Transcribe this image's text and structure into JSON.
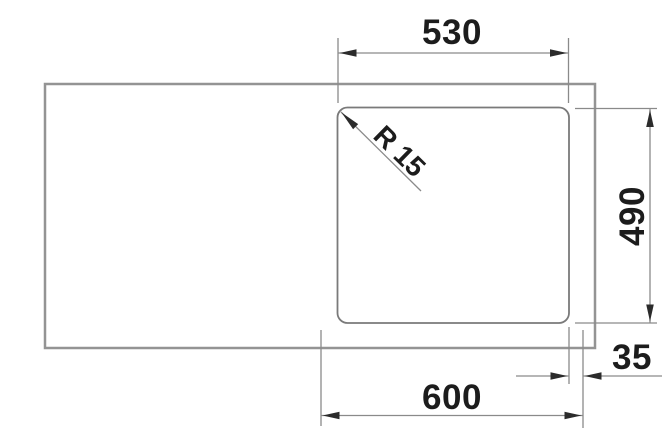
{
  "drawing": {
    "type": "technical-dimension-drawing",
    "subject": "sink-cutout-installation-plan",
    "labels": {
      "cutout_width": "530",
      "cutout_depth": "490",
      "edge_offset": "35",
      "cabinet_width": "600",
      "corner_radius": "R 15"
    },
    "colors": {
      "background": "#ffffff",
      "outline": "#949494",
      "cutout_line": "#7a7a7a",
      "dimension_line": "#8a8a8a",
      "arrow": "#2b2b2b",
      "text": "#1c1c1c"
    }
  }
}
